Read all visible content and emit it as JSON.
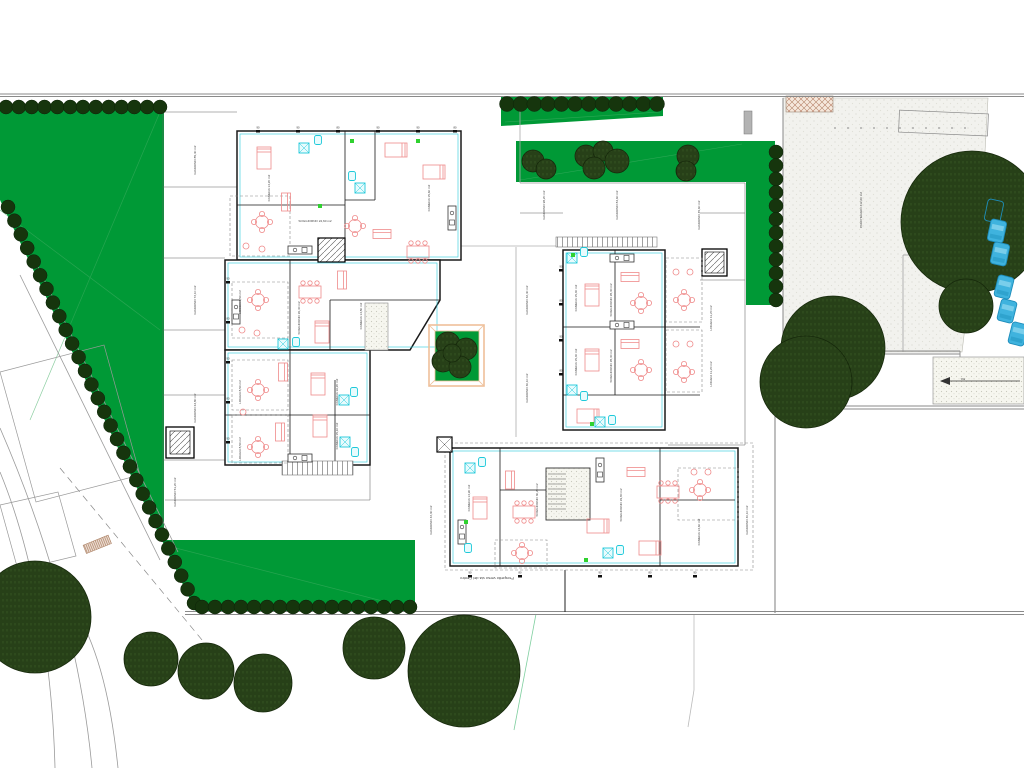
{
  "drawing": {
    "type": "architectural-site-plan",
    "caption": "Prospetto verso via del Centro",
    "ramp_slope_label": "8%"
  },
  "colors": {
    "grass": "#009936",
    "grass_line": "#3fae63",
    "hedge": "#16350d",
    "tree_fill": "#2e4a1d",
    "tree_hatch": "#1a2f0e",
    "paving": "#f2f2ee",
    "boundary": "#8a8a8a",
    "wall": "#1a1a1a",
    "furniture": "#ef8a8a",
    "fixture": "#1ec9da",
    "accent_green": "#2fd12f",
    "car": "#3fb3de",
    "planter_frame": "#eec09a"
  },
  "hedges": [
    {
      "x1": 6,
      "y1": 107,
      "x2": 160,
      "y2": 107,
      "n": 13,
      "r": 7
    },
    {
      "x1": 8,
      "y1": 207,
      "x2": 194,
      "y2": 603,
      "n": 30,
      "r": 7
    },
    {
      "x1": 202,
      "y1": 607,
      "x2": 410,
      "y2": 607,
      "n": 17,
      "r": 7
    },
    {
      "x1": 507,
      "y1": 104,
      "x2": 657,
      "y2": 104,
      "n": 12,
      "r": 7.5
    },
    {
      "x1": 776,
      "y1": 152,
      "x2": 776,
      "y2": 300,
      "n": 12,
      "r": 7
    }
  ],
  "trees": {
    "large": [
      {
        "x": 35,
        "y": 617,
        "r": 56
      },
      {
        "x": 151,
        "y": 659,
        "r": 27
      },
      {
        "x": 206,
        "y": 671,
        "r": 28
      },
      {
        "x": 263,
        "y": 683,
        "r": 29
      },
      {
        "x": 374,
        "y": 648,
        "r": 31
      },
      {
        "x": 464,
        "y": 671,
        "r": 56
      },
      {
        "x": 972,
        "y": 222,
        "r": 71
      },
      {
        "x": 966,
        "y": 306,
        "r": 27
      },
      {
        "x": 833,
        "y": 348,
        "r": 52
      },
      {
        "x": 806,
        "y": 382,
        "r": 46
      }
    ],
    "strip": [
      {
        "x": 533,
        "y": 161,
        "r": 11
      },
      {
        "x": 546,
        "y": 169,
        "r": 10
      },
      {
        "x": 586,
        "y": 156,
        "r": 11
      },
      {
        "x": 603,
        "y": 151,
        "r": 10
      },
      {
        "x": 594,
        "y": 168,
        "r": 11
      },
      {
        "x": 617,
        "y": 161,
        "r": 12
      },
      {
        "x": 688,
        "y": 156,
        "r": 11
      },
      {
        "x": 686,
        "y": 171,
        "r": 10
      }
    ],
    "planter": [
      {
        "x": 448,
        "y": 344,
        "r": 12
      },
      {
        "x": 466,
        "y": 349,
        "r": 11
      },
      {
        "x": 443,
        "y": 361,
        "r": 11
      },
      {
        "x": 460,
        "y": 367,
        "r": 11
      },
      {
        "x": 452,
        "y": 353,
        "r": 9
      }
    ]
  },
  "cars": [
    {
      "x": 994,
      "y": 211,
      "rot": 12,
      "outline": true
    },
    {
      "x": 997,
      "y": 231,
      "rot": 12
    },
    {
      "x": 1000,
      "y": 254,
      "rot": 12
    },
    {
      "x": 1004,
      "y": 287,
      "rot": 14
    },
    {
      "x": 1007,
      "y": 311,
      "rot": 14
    },
    {
      "x": 1018,
      "y": 334,
      "rot": 14
    }
  ],
  "labels": [
    {
      "x": 196,
      "y": 160,
      "r": -90,
      "t": "GIARDINO 85,40 m2"
    },
    {
      "x": 196,
      "y": 300,
      "r": -90,
      "t": "GIARDINO 72,10 m2"
    },
    {
      "x": 196,
      "y": 408,
      "r": -90,
      "t": "GIARDINO 64,80 m2"
    },
    {
      "x": 176,
      "y": 492,
      "r": -90,
      "t": "GIARDINO 51,20 m2"
    },
    {
      "x": 270,
      "y": 188,
      "r": -90,
      "t": "CAMERA 14,20 m2"
    },
    {
      "x": 430,
      "y": 198,
      "r": -90,
      "t": "CAMERA 15,60 m2"
    },
    {
      "x": 315,
      "y": 222,
      "r": 0,
      "t": "SOGGIORNO 24,60 m2"
    },
    {
      "x": 300,
      "y": 318,
      "r": -90,
      "t": "SOGGIORNO 26,40 m2"
    },
    {
      "x": 362,
      "y": 316,
      "r": -90,
      "t": "CAMERA 14,80 m2"
    },
    {
      "x": 241,
      "y": 302,
      "r": -90,
      "t": "LOGGIA 8,50 m2"
    },
    {
      "x": 241,
      "y": 392,
      "r": -90,
      "t": "LOGGIA 8,50 m2"
    },
    {
      "x": 241,
      "y": 449,
      "r": -90,
      "t": "LOGGIA 8,50 m2"
    },
    {
      "x": 338,
      "y": 392,
      "r": -90,
      "t": "CAMERA 16,20 m2"
    },
    {
      "x": 338,
      "y": 436,
      "r": -90,
      "t": "CAMERA 15,10 m2"
    },
    {
      "x": 545,
      "y": 205,
      "r": -90,
      "t": "GIARDINO 98,20 m2"
    },
    {
      "x": 618,
      "y": 205,
      "r": -90,
      "t": "GIARDINO 84,60 m2"
    },
    {
      "x": 700,
      "y": 215,
      "r": -90,
      "t": "GIARDINO 45,60 m2"
    },
    {
      "x": 528,
      "y": 300,
      "r": -90,
      "t": "GIARDINO 32,40 m2"
    },
    {
      "x": 528,
      "y": 388,
      "r": -90,
      "t": "GIARDINO 30,10 m2"
    },
    {
      "x": 577,
      "y": 298,
      "r": -90,
      "t": "CAMERA 15,40 m2"
    },
    {
      "x": 612,
      "y": 300,
      "r": -90,
      "t": "SOGGIORNO 28,30 m2"
    },
    {
      "x": 577,
      "y": 362,
      "r": -90,
      "t": "CAMERA 15,40 m2"
    },
    {
      "x": 612,
      "y": 366,
      "r": -90,
      "t": "SOGGIORNO 28,30 m2"
    },
    {
      "x": 712,
      "y": 318,
      "r": -90,
      "t": "LOGGIA 11,20 m2"
    },
    {
      "x": 712,
      "y": 374,
      "r": -90,
      "t": "LOGGIA 11,20 m2"
    },
    {
      "x": 432,
      "y": 520,
      "r": -90,
      "t": "GIARDINO 42,30 m2"
    },
    {
      "x": 748,
      "y": 520,
      "r": -90,
      "t": "GIARDINO 40,10 m2"
    },
    {
      "x": 470,
      "y": 498,
      "r": -90,
      "t": "CAMERA 14,90 m2"
    },
    {
      "x": 538,
      "y": 500,
      "r": -90,
      "t": "SOGGIORNO 30,20 m2"
    },
    {
      "x": 622,
      "y": 505,
      "r": -90,
      "t": "SOGGIORNO 29,80 m2"
    },
    {
      "x": 700,
      "y": 532,
      "r": -90,
      "t": "CAMERA 13,60 m2"
    },
    {
      "x": 862,
      "y": 210,
      "r": -90,
      "t": "PARCHEGGIO 412,60 m2"
    },
    {
      "x": 963,
      "y": 378,
      "r": 180,
      "t": "8%"
    },
    {
      "x": 487,
      "y": 577,
      "r": 180,
      "t": "Prospetto verso via del Centro",
      "s": 4
    }
  ],
  "dims": [
    {
      "x": 258,
      "y": 129,
      "t": "90"
    },
    {
      "x": 298,
      "y": 129,
      "t": "90"
    },
    {
      "x": 338,
      "y": 129,
      "t": "80"
    },
    {
      "x": 378,
      "y": 129,
      "t": "90"
    },
    {
      "x": 418,
      "y": 129,
      "t": "90"
    },
    {
      "x": 455,
      "y": 129,
      "t": "80"
    },
    {
      "x": 561,
      "y": 268,
      "t": "90"
    },
    {
      "x": 561,
      "y": 302,
      "t": "80"
    },
    {
      "x": 561,
      "y": 338,
      "t": "90"
    },
    {
      "x": 561,
      "y": 372,
      "t": "80"
    },
    {
      "x": 470,
      "y": 574,
      "t": "90"
    },
    {
      "x": 520,
      "y": 574,
      "t": "80"
    },
    {
      "x": 600,
      "y": 574,
      "t": "90"
    },
    {
      "x": 650,
      "y": 574,
      "t": "80"
    },
    {
      "x": 695,
      "y": 574,
      "t": "90"
    },
    {
      "x": 228,
      "y": 280,
      "t": "90"
    },
    {
      "x": 228,
      "y": 320,
      "t": "80"
    },
    {
      "x": 228,
      "y": 360,
      "t": "90"
    },
    {
      "x": 228,
      "y": 400,
      "t": "80"
    },
    {
      "x": 228,
      "y": 440,
      "t": "90"
    }
  ],
  "furniture": [
    [
      "bed",
      264,
      158,
      0
    ],
    [
      "bed",
      396,
      150,
      90
    ],
    [
      "bed",
      434,
      172,
      90
    ],
    [
      "shower",
      304,
      148,
      0
    ],
    [
      "wc",
      318,
      140,
      0
    ],
    [
      "shower",
      360,
      188,
      0
    ],
    [
      "wc",
      352,
      176,
      0
    ],
    [
      "rtab",
      262,
      222,
      0
    ],
    [
      "chair",
      246,
      246,
      0
    ],
    [
      "chair",
      262,
      249,
      0
    ],
    [
      "sofa",
      286,
      202,
      90
    ],
    [
      "kit",
      300,
      250,
      0
    ],
    [
      "table",
      418,
      252,
      0
    ],
    [
      "rtab",
      355,
      226,
      0
    ],
    [
      "kit",
      452,
      218,
      90
    ],
    [
      "sofa",
      382,
      234,
      0
    ],
    [
      "rtab",
      258,
      300,
      0
    ],
    [
      "chair",
      242,
      330,
      0
    ],
    [
      "chair",
      257,
      333,
      0
    ],
    [
      "table",
      310,
      292,
      0
    ],
    [
      "sofa",
      342,
      280,
      90
    ],
    [
      "kit",
      236,
      312,
      90
    ],
    [
      "bed",
      322,
      332,
      0
    ],
    [
      "wc",
      296,
      342,
      0
    ],
    [
      "shower",
      283,
      344,
      0
    ],
    [
      "rtab",
      258,
      390,
      0
    ],
    [
      "chair",
      243,
      412,
      0
    ],
    [
      "bed",
      318,
      384,
      0
    ],
    [
      "sofa",
      283,
      372,
      90
    ],
    [
      "shower",
      344,
      400,
      0
    ],
    [
      "wc",
      354,
      392,
      0
    ],
    [
      "rtab",
      258,
      447,
      0
    ],
    [
      "bed",
      320,
      426,
      0
    ],
    [
      "kit",
      300,
      458,
      0
    ],
    [
      "shower",
      345,
      442,
      0
    ],
    [
      "wc",
      355,
      452,
      0
    ],
    [
      "sofa",
      280,
      432,
      90
    ],
    [
      "kit",
      622,
      258,
      0
    ],
    [
      "shower",
      572,
      258,
      0
    ],
    [
      "wc",
      584,
      252,
      0
    ],
    [
      "bed",
      592,
      295,
      0
    ],
    [
      "rtab",
      641,
      303,
      0
    ],
    [
      "sofa",
      630,
      277,
      0
    ],
    [
      "rtab",
      684,
      300,
      0
    ],
    [
      "chair",
      676,
      272,
      0
    ],
    [
      "chair",
      690,
      272,
      0
    ],
    [
      "kit",
      622,
      325,
      0
    ],
    [
      "bed",
      592,
      360,
      0
    ],
    [
      "rtab",
      641,
      370,
      0
    ],
    [
      "rtab",
      684,
      372,
      0
    ],
    [
      "chair",
      676,
      344,
      0
    ],
    [
      "chair",
      690,
      344,
      0
    ],
    [
      "shower",
      572,
      390,
      0
    ],
    [
      "wc",
      584,
      396,
      0
    ],
    [
      "sofa",
      630,
      344,
      0
    ],
    [
      "bed",
      588,
      416,
      90
    ],
    [
      "wc",
      612,
      420,
      0
    ],
    [
      "shower",
      600,
      422,
      0
    ],
    [
      "shower",
      470,
      468,
      0
    ],
    [
      "wc",
      482,
      462,
      0
    ],
    [
      "sofa",
      510,
      480,
      90
    ],
    [
      "bed",
      480,
      508,
      0
    ],
    [
      "table",
      524,
      512,
      0
    ],
    [
      "kit",
      462,
      532,
      90
    ],
    [
      "rtab",
      522,
      553,
      0
    ],
    [
      "wc",
      468,
      548,
      0
    ],
    [
      "kit",
      600,
      470,
      90
    ],
    [
      "sofa",
      636,
      472,
      0
    ],
    [
      "table",
      668,
      492,
      0
    ],
    [
      "bed",
      598,
      526,
      90
    ],
    [
      "bed",
      650,
      548,
      90
    ],
    [
      "rtab",
      700,
      490,
      0
    ],
    [
      "chair",
      694,
      472,
      0
    ],
    [
      "chair",
      708,
      472,
      0
    ],
    [
      "wc",
      620,
      550,
      0
    ],
    [
      "shower",
      608,
      553,
      0
    ],
    [
      "grn",
      320,
      206,
      0
    ],
    [
      "grn",
      418,
      141,
      0
    ],
    [
      "grn",
      573,
      255,
      0
    ],
    [
      "grn",
      592,
      424,
      0
    ],
    [
      "grn",
      466,
      522,
      0
    ],
    [
      "grn",
      586,
      560,
      0
    ],
    [
      "grn",
      352,
      141,
      0
    ]
  ]
}
